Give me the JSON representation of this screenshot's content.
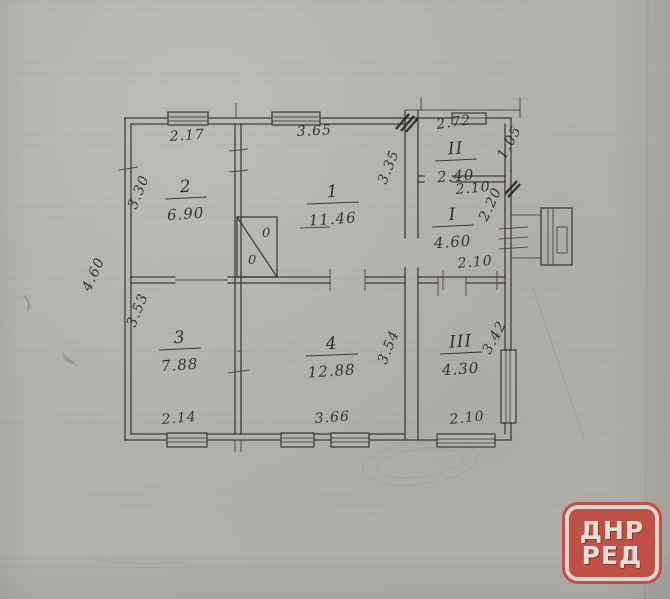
{
  "watermark": {
    "line1": "ДНР",
    "line2": "РЕД",
    "color": "#c24a3e"
  },
  "plan": {
    "stroke_color": "#34312b",
    "rooms": [
      {
        "number": "2",
        "area": "6.90",
        "x": 186,
        "y": 192
      },
      {
        "number": "1",
        "area": "11.46",
        "x": 333,
        "y": 197
      },
      {
        "number": "3",
        "area": "7.88",
        "x": 180,
        "y": 343
      },
      {
        "number": "4",
        "area": "12.88",
        "x": 332,
        "y": 349
      },
      {
        "number": "II",
        "area": "2.40",
        "x": 456,
        "y": 154
      },
      {
        "number": "I",
        "area": "4.60",
        "x": 453,
        "y": 220
      },
      {
        "number": "III",
        "area": "4.30",
        "x": 461,
        "y": 347
      }
    ],
    "dimensions": [
      {
        "text": "2.17",
        "x": 170,
        "y": 141,
        "rot": -4
      },
      {
        "text": "3.65",
        "x": 297,
        "y": 136,
        "rot": -3
      },
      {
        "text": "2.72",
        "x": 437,
        "y": 129,
        "rot": -8
      },
      {
        "text": "1.05",
        "x": 505,
        "y": 160,
        "rot": -62
      },
      {
        "text": "3.30",
        "x": 136,
        "y": 210,
        "rot": -68
      },
      {
        "text": "3.35",
        "x": 386,
        "y": 185,
        "rot": -68
      },
      {
        "text": "2.10",
        "x": 456,
        "y": 194,
        "rot": -5
      },
      {
        "text": "2.20",
        "x": 487,
        "y": 222,
        "rot": -65
      },
      {
        "text": "2.10",
        "x": 458,
        "y": 268,
        "rot": -5
      },
      {
        "text": "4.60",
        "x": 90,
        "y": 292,
        "rot": -65
      },
      {
        "text": "3.53",
        "x": 135,
        "y": 328,
        "rot": -68
      },
      {
        "text": "3.54",
        "x": 386,
        "y": 365,
        "rot": -68
      },
      {
        "text": "3.42",
        "x": 490,
        "y": 355,
        "rot": -62
      },
      {
        "text": "2.14",
        "x": 162,
        "y": 424,
        "rot": -5
      },
      {
        "text": "3.66",
        "x": 315,
        "y": 423,
        "rot": -4
      },
      {
        "text": "2.10",
        "x": 450,
        "y": 424,
        "rot": -6
      }
    ],
    "stove_marks": [
      {
        "text": "0",
        "x": 262,
        "y": 237
      },
      {
        "text": "0",
        "x": 248,
        "y": 264
      }
    ]
  }
}
